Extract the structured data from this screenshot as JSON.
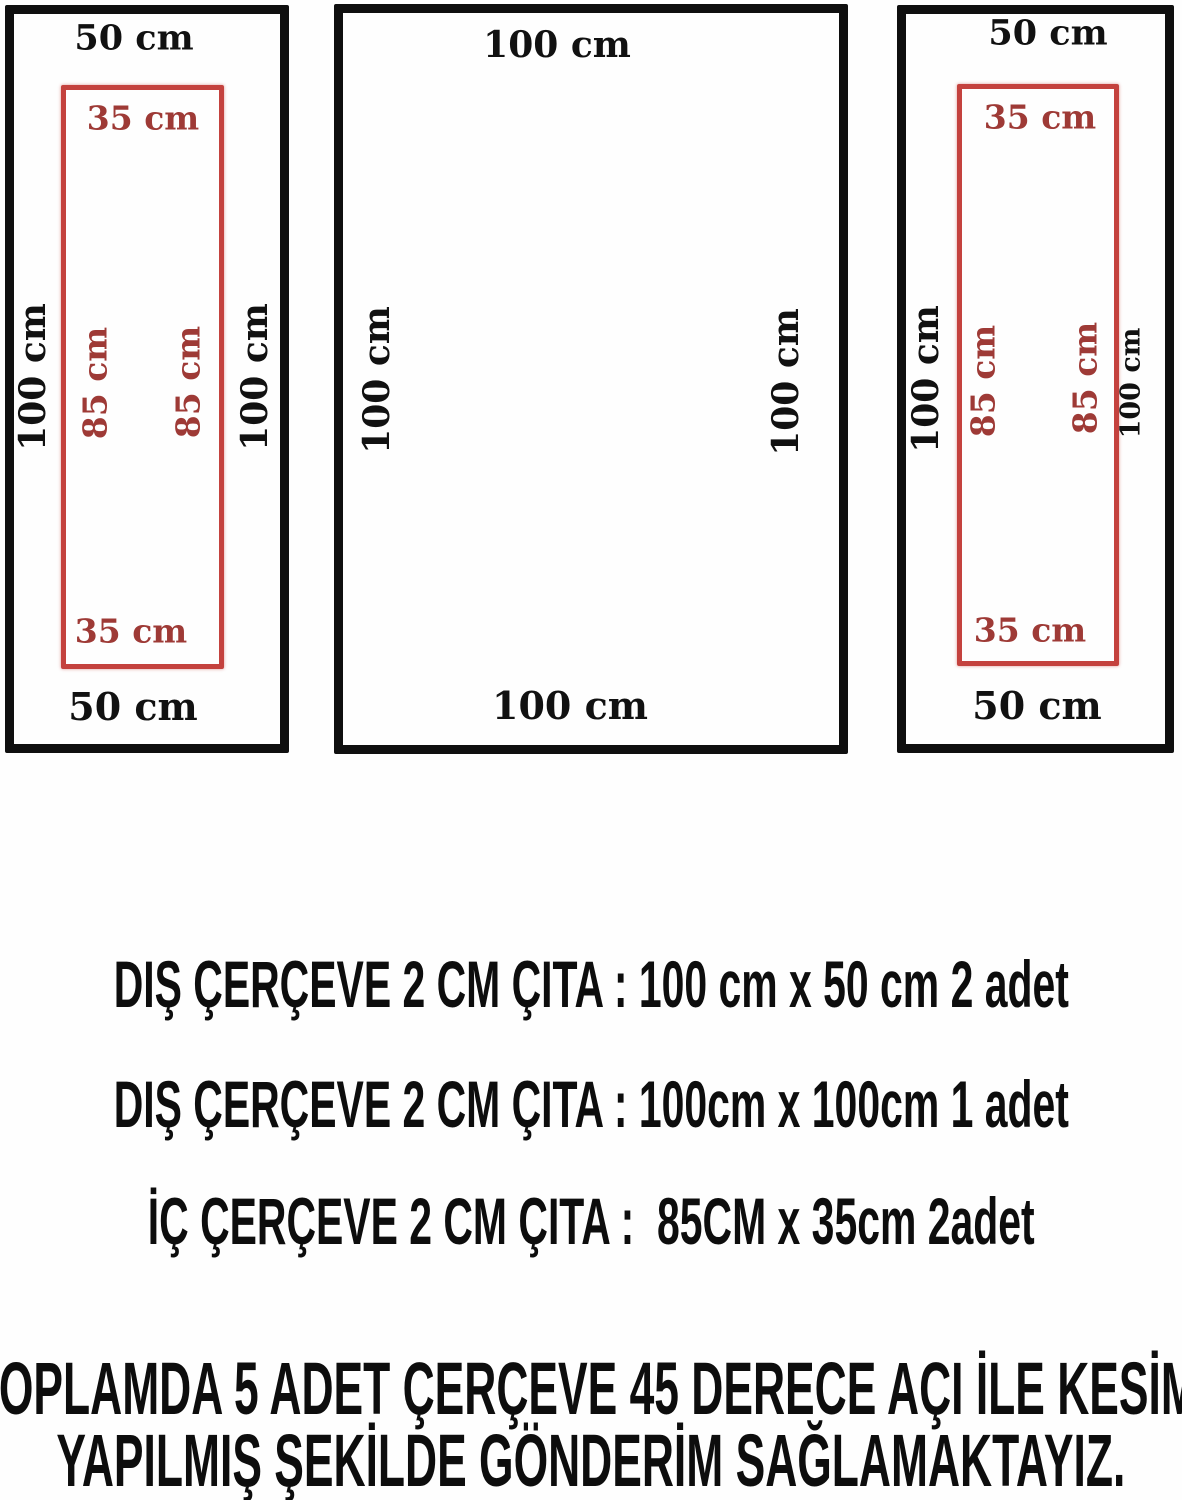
{
  "diagram": {
    "left_frame": {
      "top_label": "50 cm",
      "bottom_label": "50 cm",
      "side_left_label": "100 cm",
      "side_right_label": "100 cm",
      "inner": {
        "top_label": "35 cm",
        "bottom_label": "35 cm",
        "side_left_label": "85 cm",
        "side_right_label": "85 cm"
      }
    },
    "middle_frame": {
      "top_label": "100 cm",
      "bottom_label": "100 cm",
      "side_left_label": "100 cm",
      "side_right_label": "100 cm"
    },
    "right_frame": {
      "top_label": "50 cm",
      "bottom_label": "50 cm",
      "side_left_label": "100 cm",
      "side_right_label": "100 cm",
      "inner": {
        "top_label": "35 cm",
        "bottom_label": "35 cm",
        "side_left_label": "85 cm",
        "side_right_label": "85 cm"
      }
    }
  },
  "specs": {
    "line1": "DIŞ ÇERÇEVE 2 CM ÇITA : 100 cm x 50 cm 2 adet",
    "line2": "DIŞ ÇERÇEVE 2 CM ÇITA : 100cm x 100cm 1 adet",
    "line3": "İÇ ÇERÇEVE 2 CM ÇITA :  85CM x 35cm 2adet"
  },
  "footer": {
    "line1": "TOPLAMDA 5 ADET ÇERÇEVE 45 DERECE AÇI İLE KESİMİ",
    "line2": "YAPILMIŞ ŞEKİLDE GÖNDERİM SAĞLAMAKTAYIZ."
  },
  "colors": {
    "frame_black": "#0f0f0f",
    "inner_red_border": "#c4423e",
    "red_text": "#9e3a36",
    "black_text": "#0d0d0d",
    "background": "#fefefe"
  }
}
